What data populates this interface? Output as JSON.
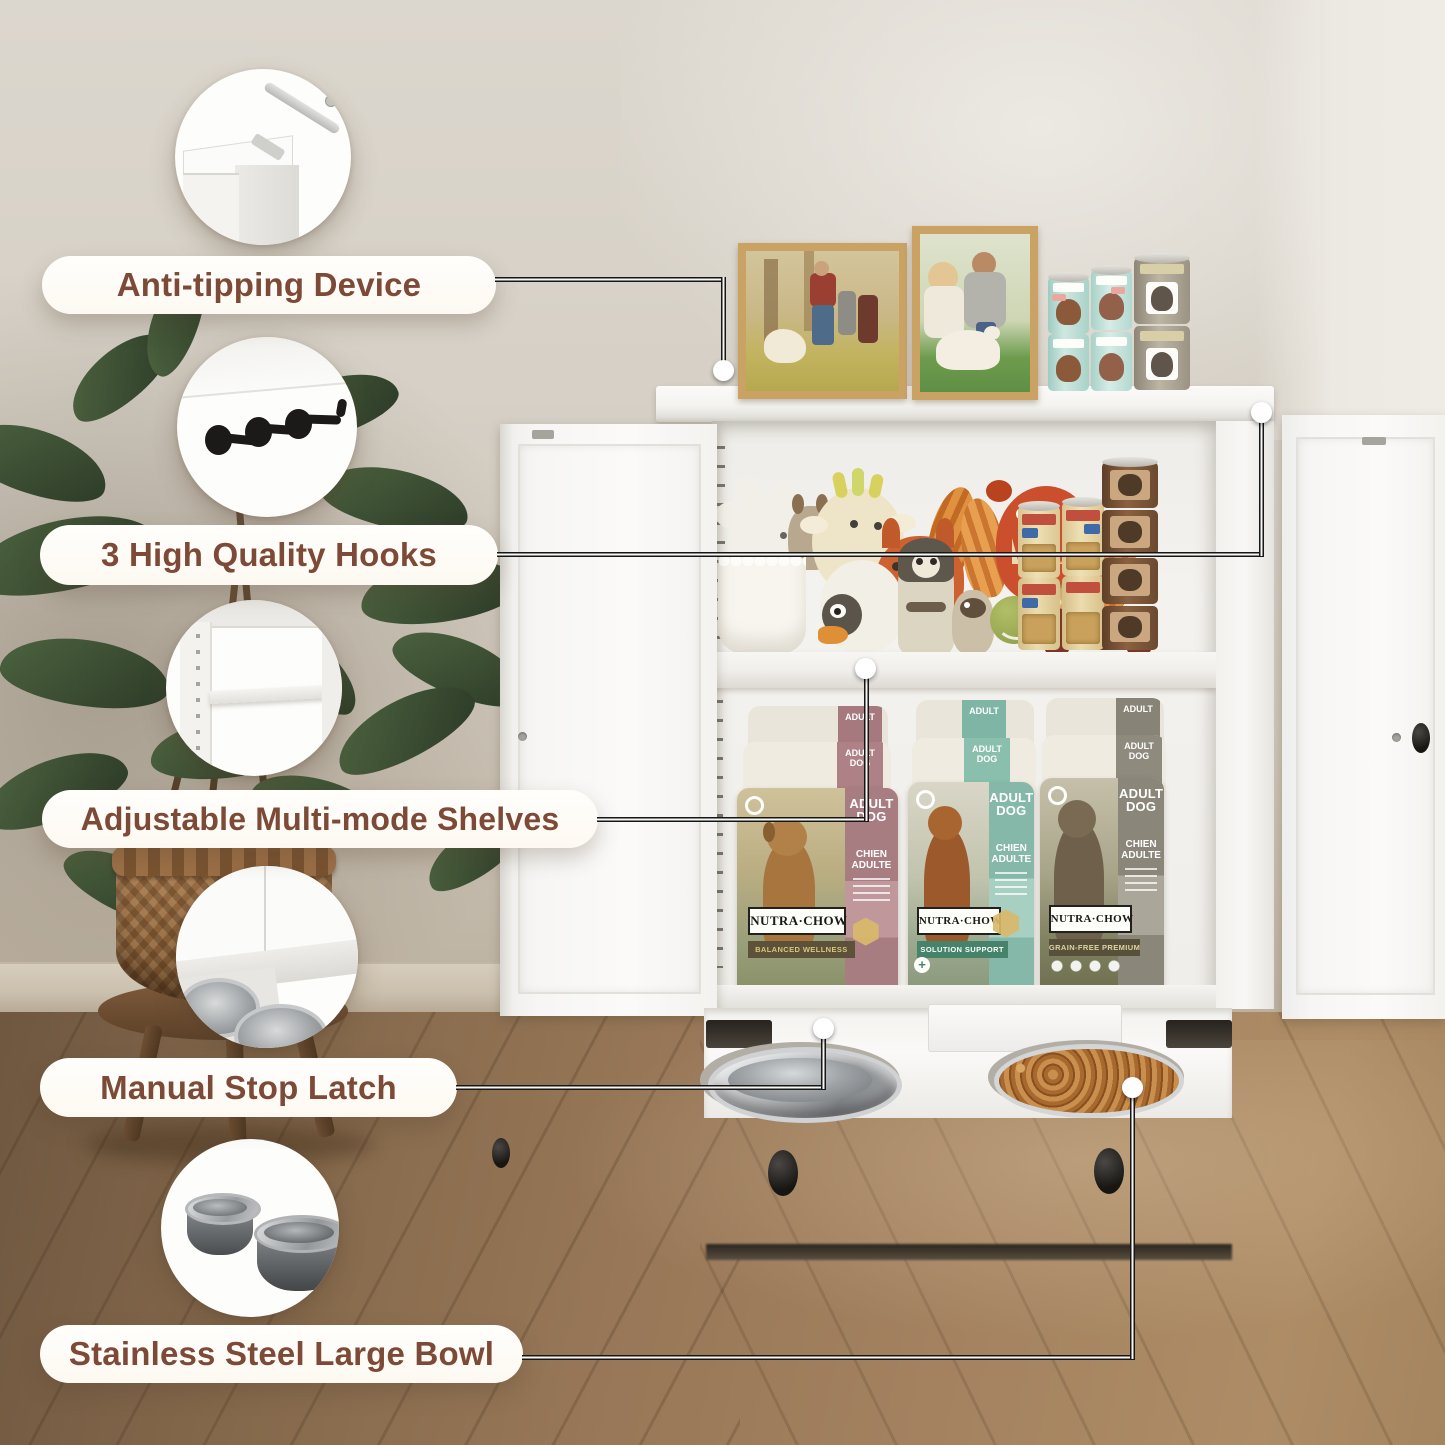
{
  "callouts": [
    {
      "label": "Anti-tipping Device",
      "icon": "anti-tip-bracket-icon"
    },
    {
      "label": "3 High Quality Hooks",
      "icon": "three-hooks-icon"
    },
    {
      "label": "Adjustable Multi-mode Shelves",
      "icon": "adjustable-shelves-icon"
    },
    {
      "label": "Manual Stop Latch",
      "icon": "stop-latch-icon"
    },
    {
      "label": "Stainless Steel Large Bowl",
      "icon": "stainless-bowls-icon"
    }
  ],
  "dog_food_bags": [
    {
      "brand": "NUTRA·CHOW",
      "line": "BALANCED WELLNESS",
      "variant": "ADULT DOG",
      "variant_fr": "CHIEN ADULTE",
      "variant_short": "ADULT",
      "accent": "#b18a8c",
      "banner": "#5c5139"
    },
    {
      "brand": "NUTRA·CHOW",
      "line": "SOLUTION SUPPORT",
      "variant": "ADULT DOG",
      "variant_fr": "CHIEN ADULTE",
      "variant_short": "ADULT",
      "accent": "#8fc2b2",
      "banner": "#45836a"
    },
    {
      "brand": "NUTRA·CHOW",
      "line": "GRAIN-FREE PREMIUM",
      "variant": "ADULT DOG",
      "variant_fr": "CHIEN ADULTE",
      "variant_short": "ADULT",
      "accent": "#928d80",
      "banner": "#57513c"
    }
  ],
  "colors": {
    "label_text": "#7d4a38",
    "pill_bg": "#fffdf8",
    "leader_line": "#161616",
    "wall": "#d5cec4",
    "floor_wood": "#9a7a57",
    "cabinet_white": "#f8f7f5",
    "bag_accent_mauve": "#b18a8c",
    "bag_accent_teal": "#8fc2b2",
    "bag_accent_gray": "#928d80"
  }
}
